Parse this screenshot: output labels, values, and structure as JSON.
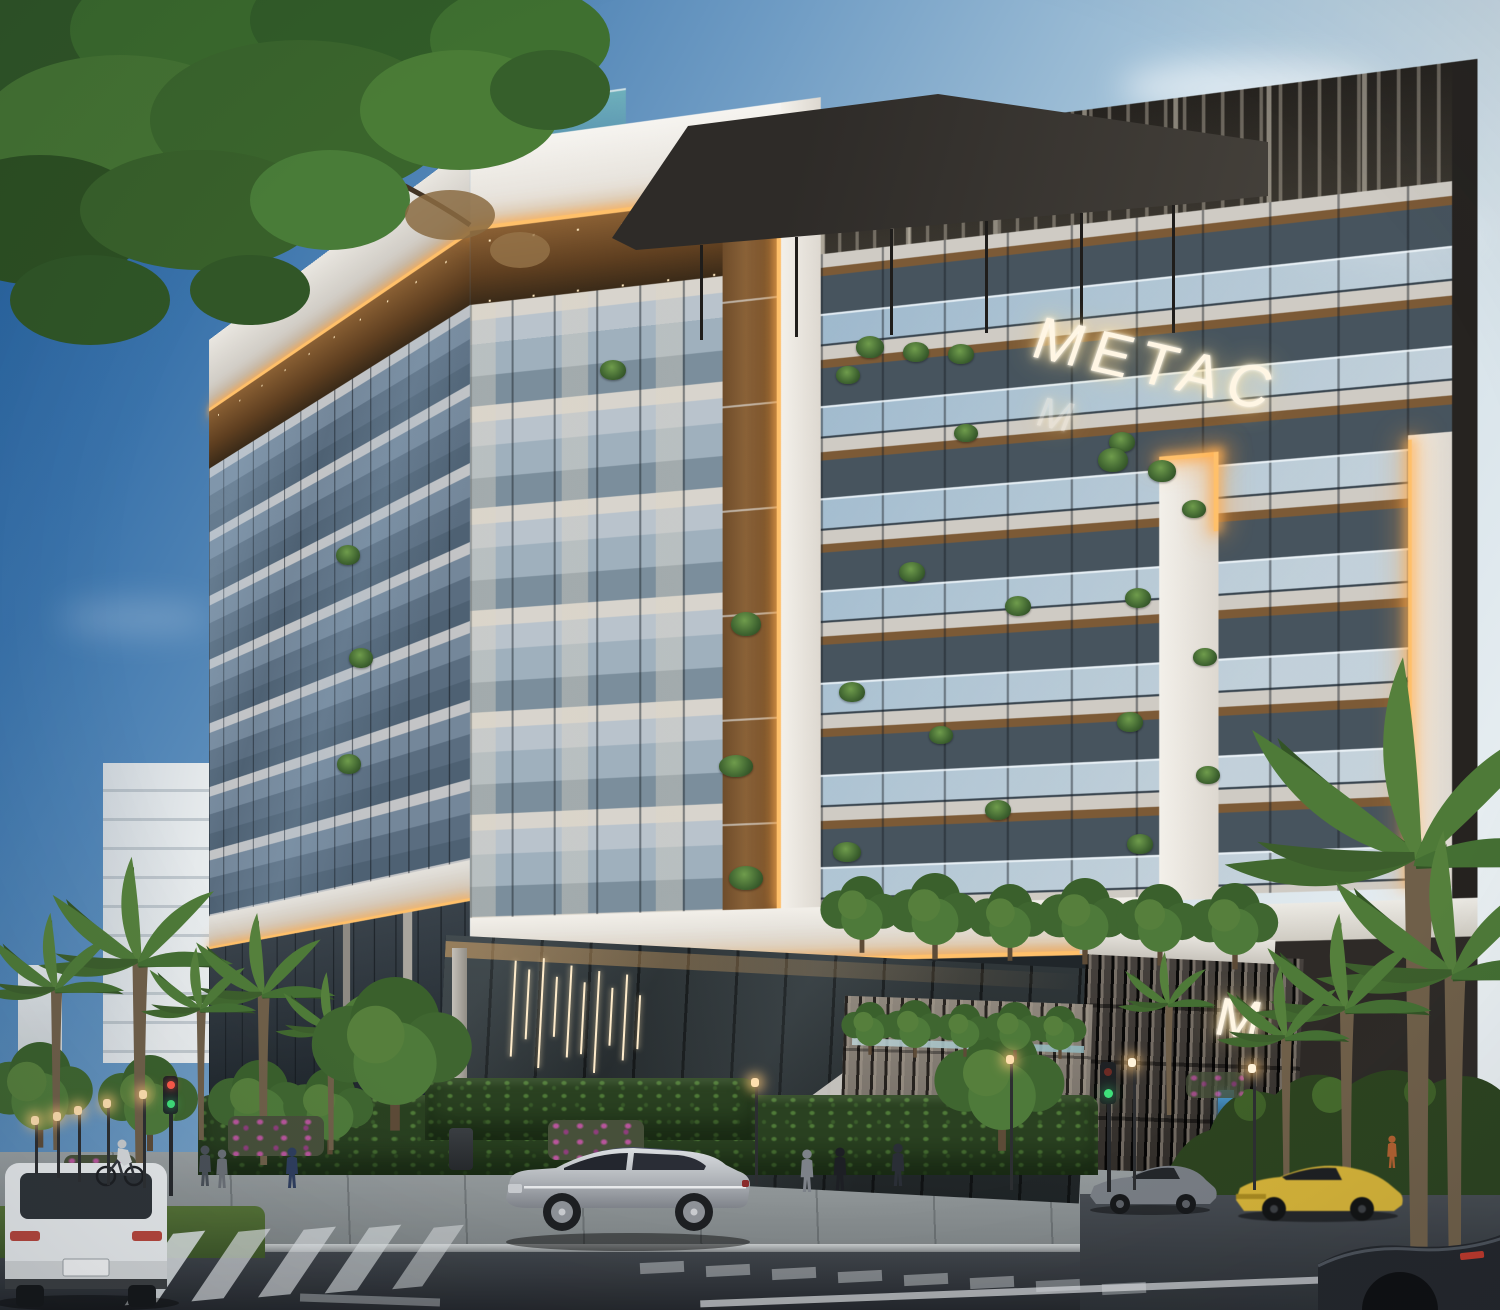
{
  "scene": {
    "signage": {
      "rooftop_sign": "METAC",
      "rooftop_sign_secondary": "M",
      "podium_monogram": "M"
    },
    "palette": {
      "sky_deep": "#1f5c9b",
      "sky_pale": "#e9eff2",
      "led_accent": "#ffc06a",
      "wood": "#8a6034",
      "facade_white": "#f3f0ea",
      "glass_blue": "#8fa5b4",
      "pergola_dark": "#2e2b28",
      "podium_dark": "#3b3734",
      "hedge_green": "#2a4121",
      "road_asphalt": "#2b2f34",
      "car_yellow": "#d2b23c",
      "car_silver": "#b6bac0",
      "traffic_signal_state_color": "#3fe07a"
    },
    "environment": {
      "vehicles": [
        "white-suv",
        "silver-sedan",
        "gray-coupe",
        "yellow-sports-car",
        "dark-muscle-car"
      ],
      "pedestrian_count": 8,
      "traffic_signal_state": "green"
    }
  }
}
